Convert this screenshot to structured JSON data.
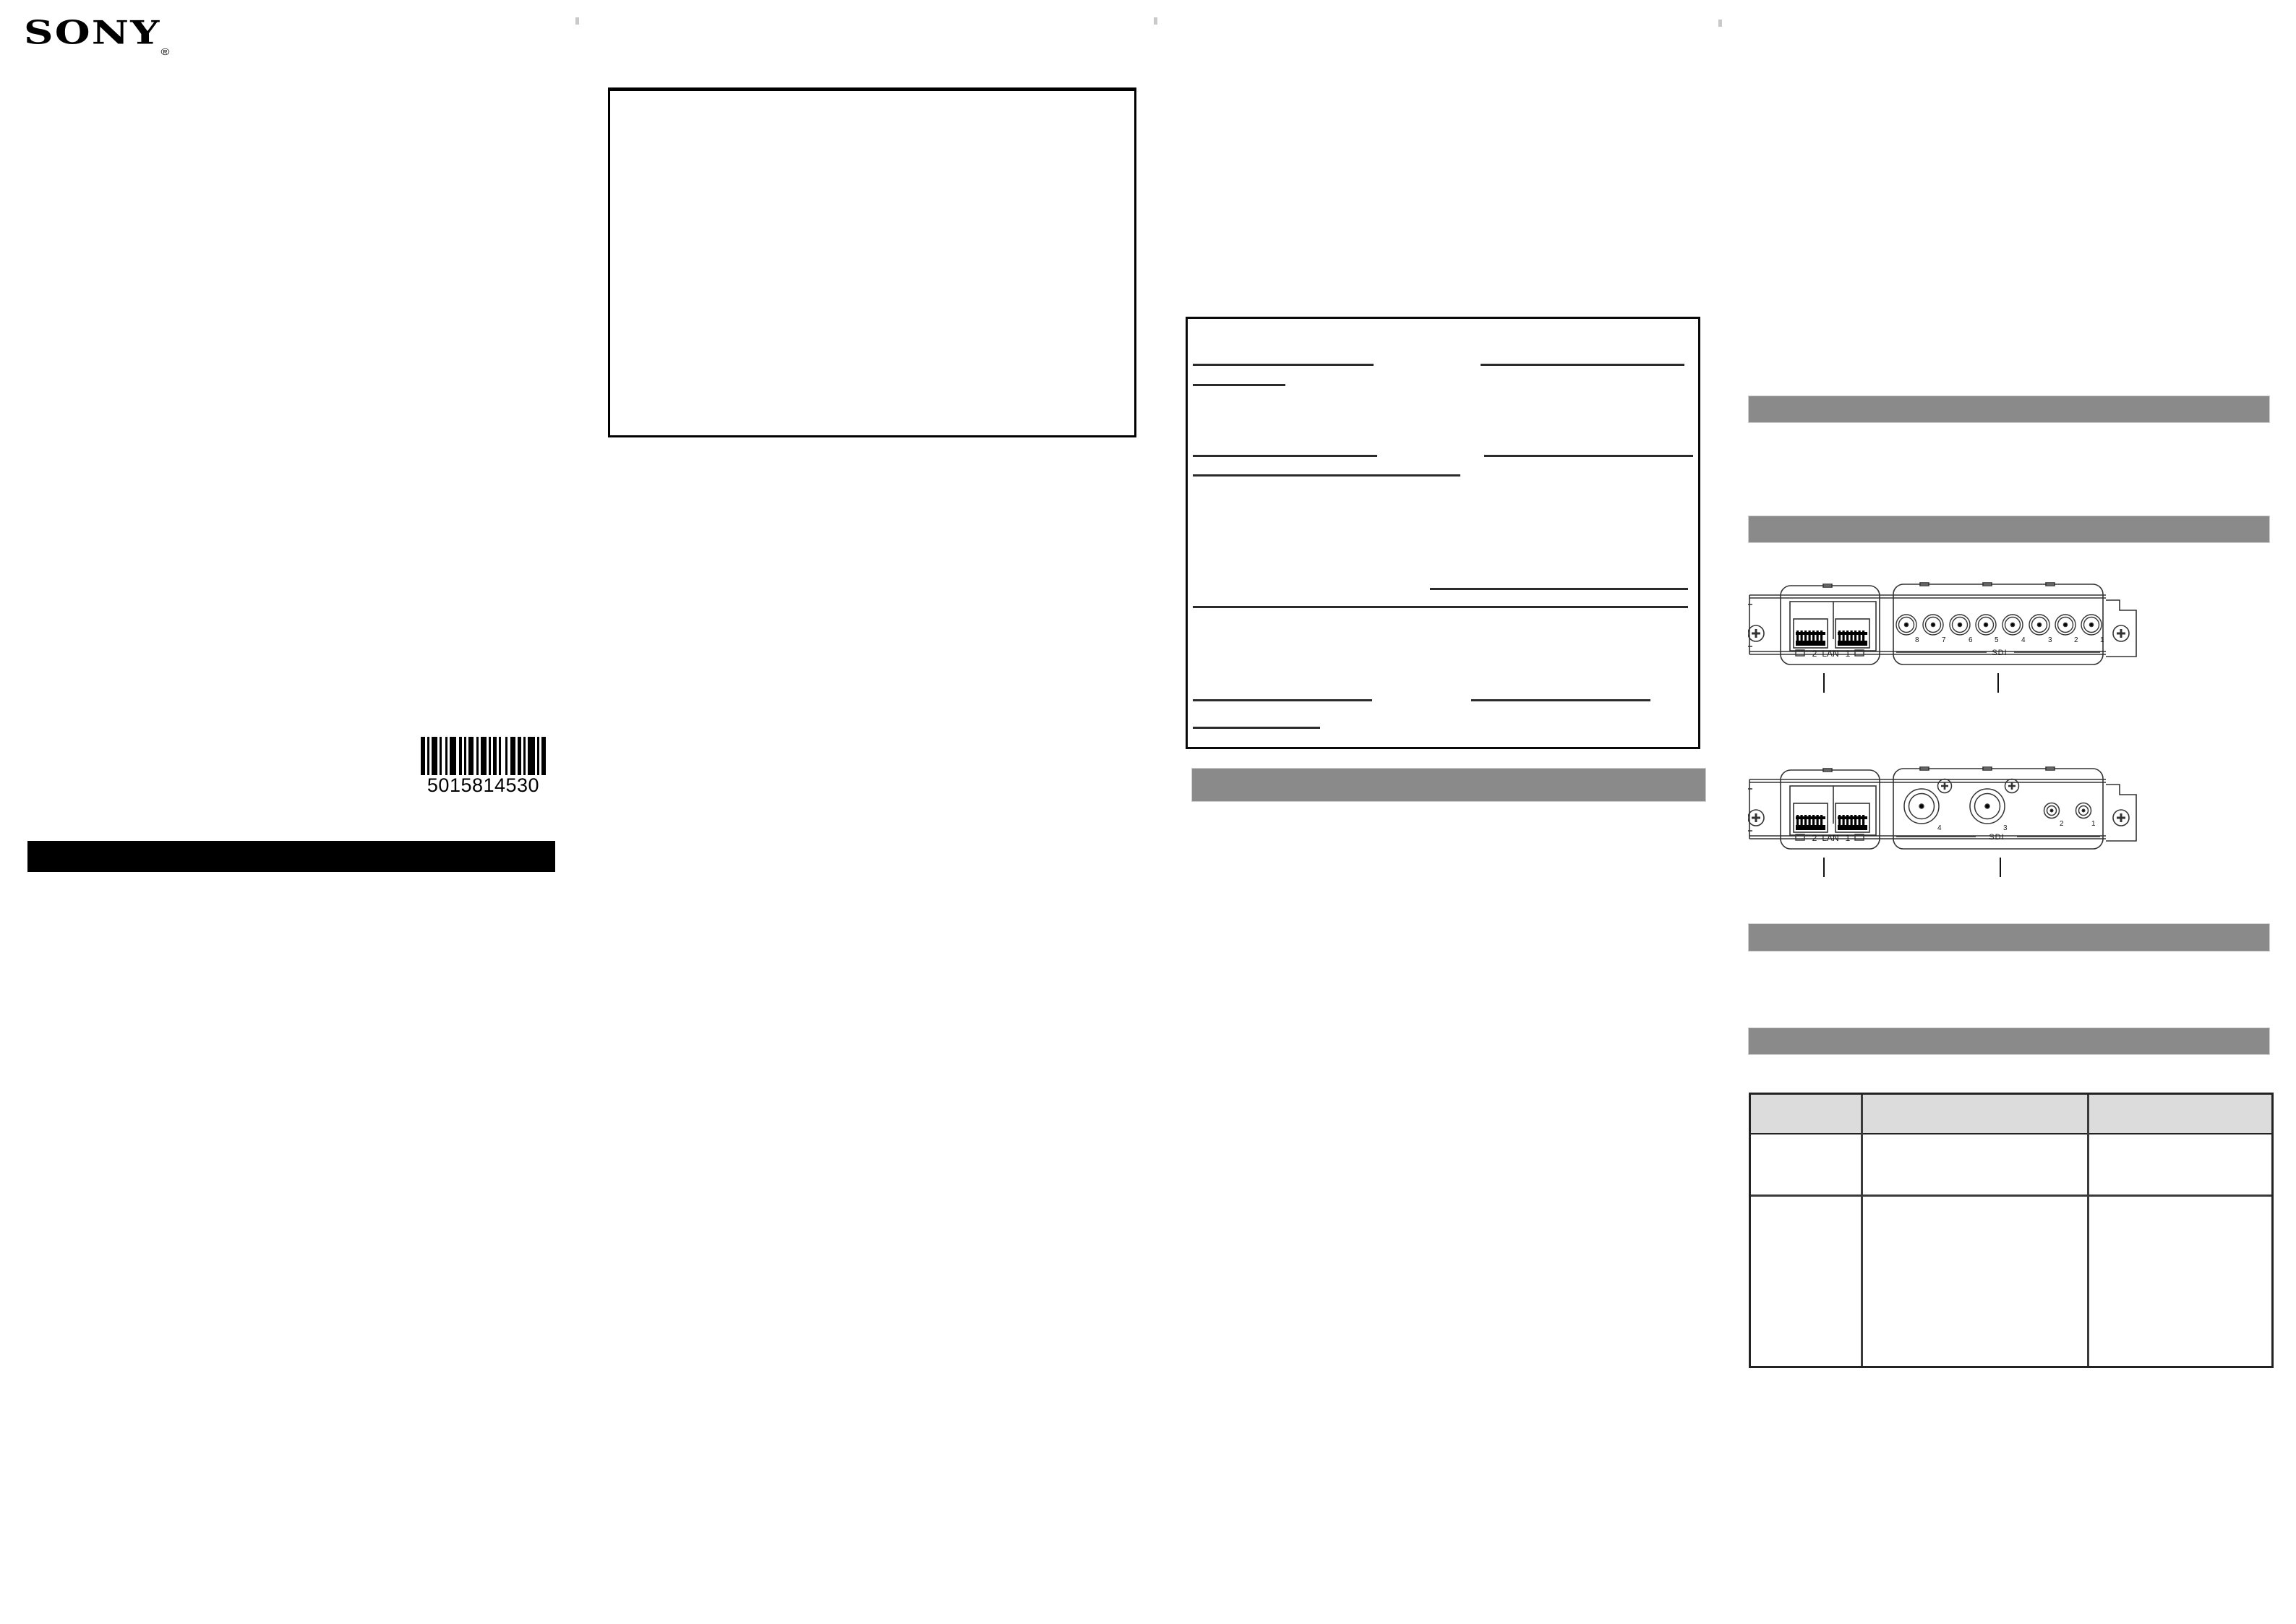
{
  "brand": {
    "logo_text": "SONY",
    "registered_mark": "®"
  },
  "barcode": {
    "number": "5015814530",
    "pattern": [
      4,
      2,
      2,
      2,
      5,
      2,
      2,
      3,
      2,
      2,
      6,
      2,
      3,
      2,
      2,
      2,
      4,
      3,
      2,
      2,
      5,
      2,
      2,
      2,
      3,
      2,
      2,
      4,
      2,
      2,
      5,
      2,
      3,
      2,
      2,
      2,
      6,
      2,
      2,
      2,
      4
    ]
  },
  "panel_diagram_8ch": {
    "lan": {
      "label": "LAN",
      "port2": "2",
      "port1": "1"
    },
    "sdi": {
      "label": "SDI",
      "connector_numbers": [
        "8",
        "7",
        "6",
        "5",
        "4",
        "3",
        "2",
        "1"
      ]
    }
  },
  "panel_diagram_4ch": {
    "lan": {
      "label": "LAN",
      "port2": "2",
      "port1": "1"
    },
    "sdi": {
      "label": "SDI",
      "large_connector_numbers": [
        "4",
        "3"
      ],
      "small_connector_numbers": [
        "2",
        "1"
      ]
    }
  },
  "colors": {
    "section_bar_gray": "#8a8a8a",
    "table_header_gray": "#dcdcdc",
    "ink": "#111111"
  }
}
